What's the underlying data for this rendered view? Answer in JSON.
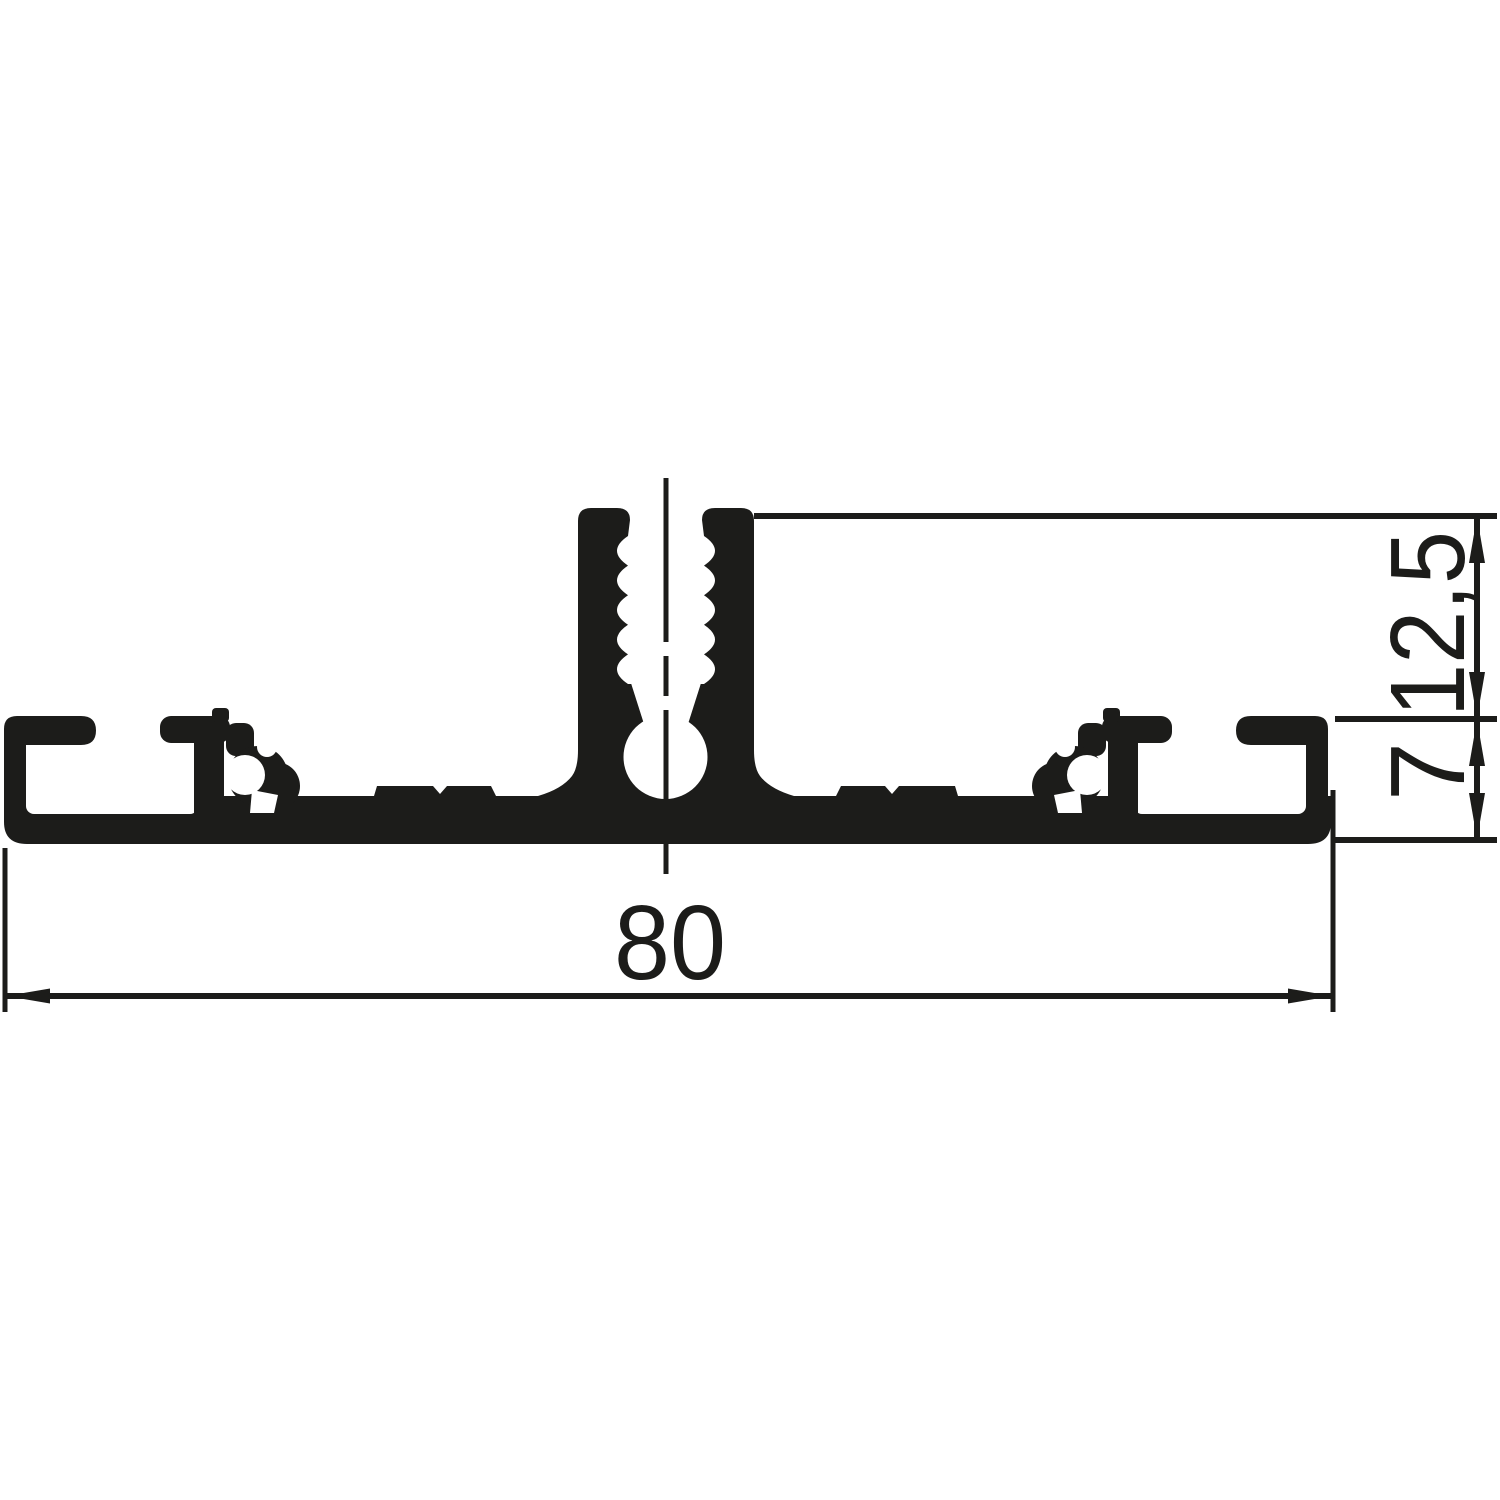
{
  "drawing": {
    "background_color": "#ffffff",
    "ink_color": "#1c1c1a",
    "dimensions": {
      "width": {
        "label": "80"
      },
      "upper_height": {
        "label": "12,5"
      },
      "base_thickness": {
        "label": "7"
      }
    }
  }
}
